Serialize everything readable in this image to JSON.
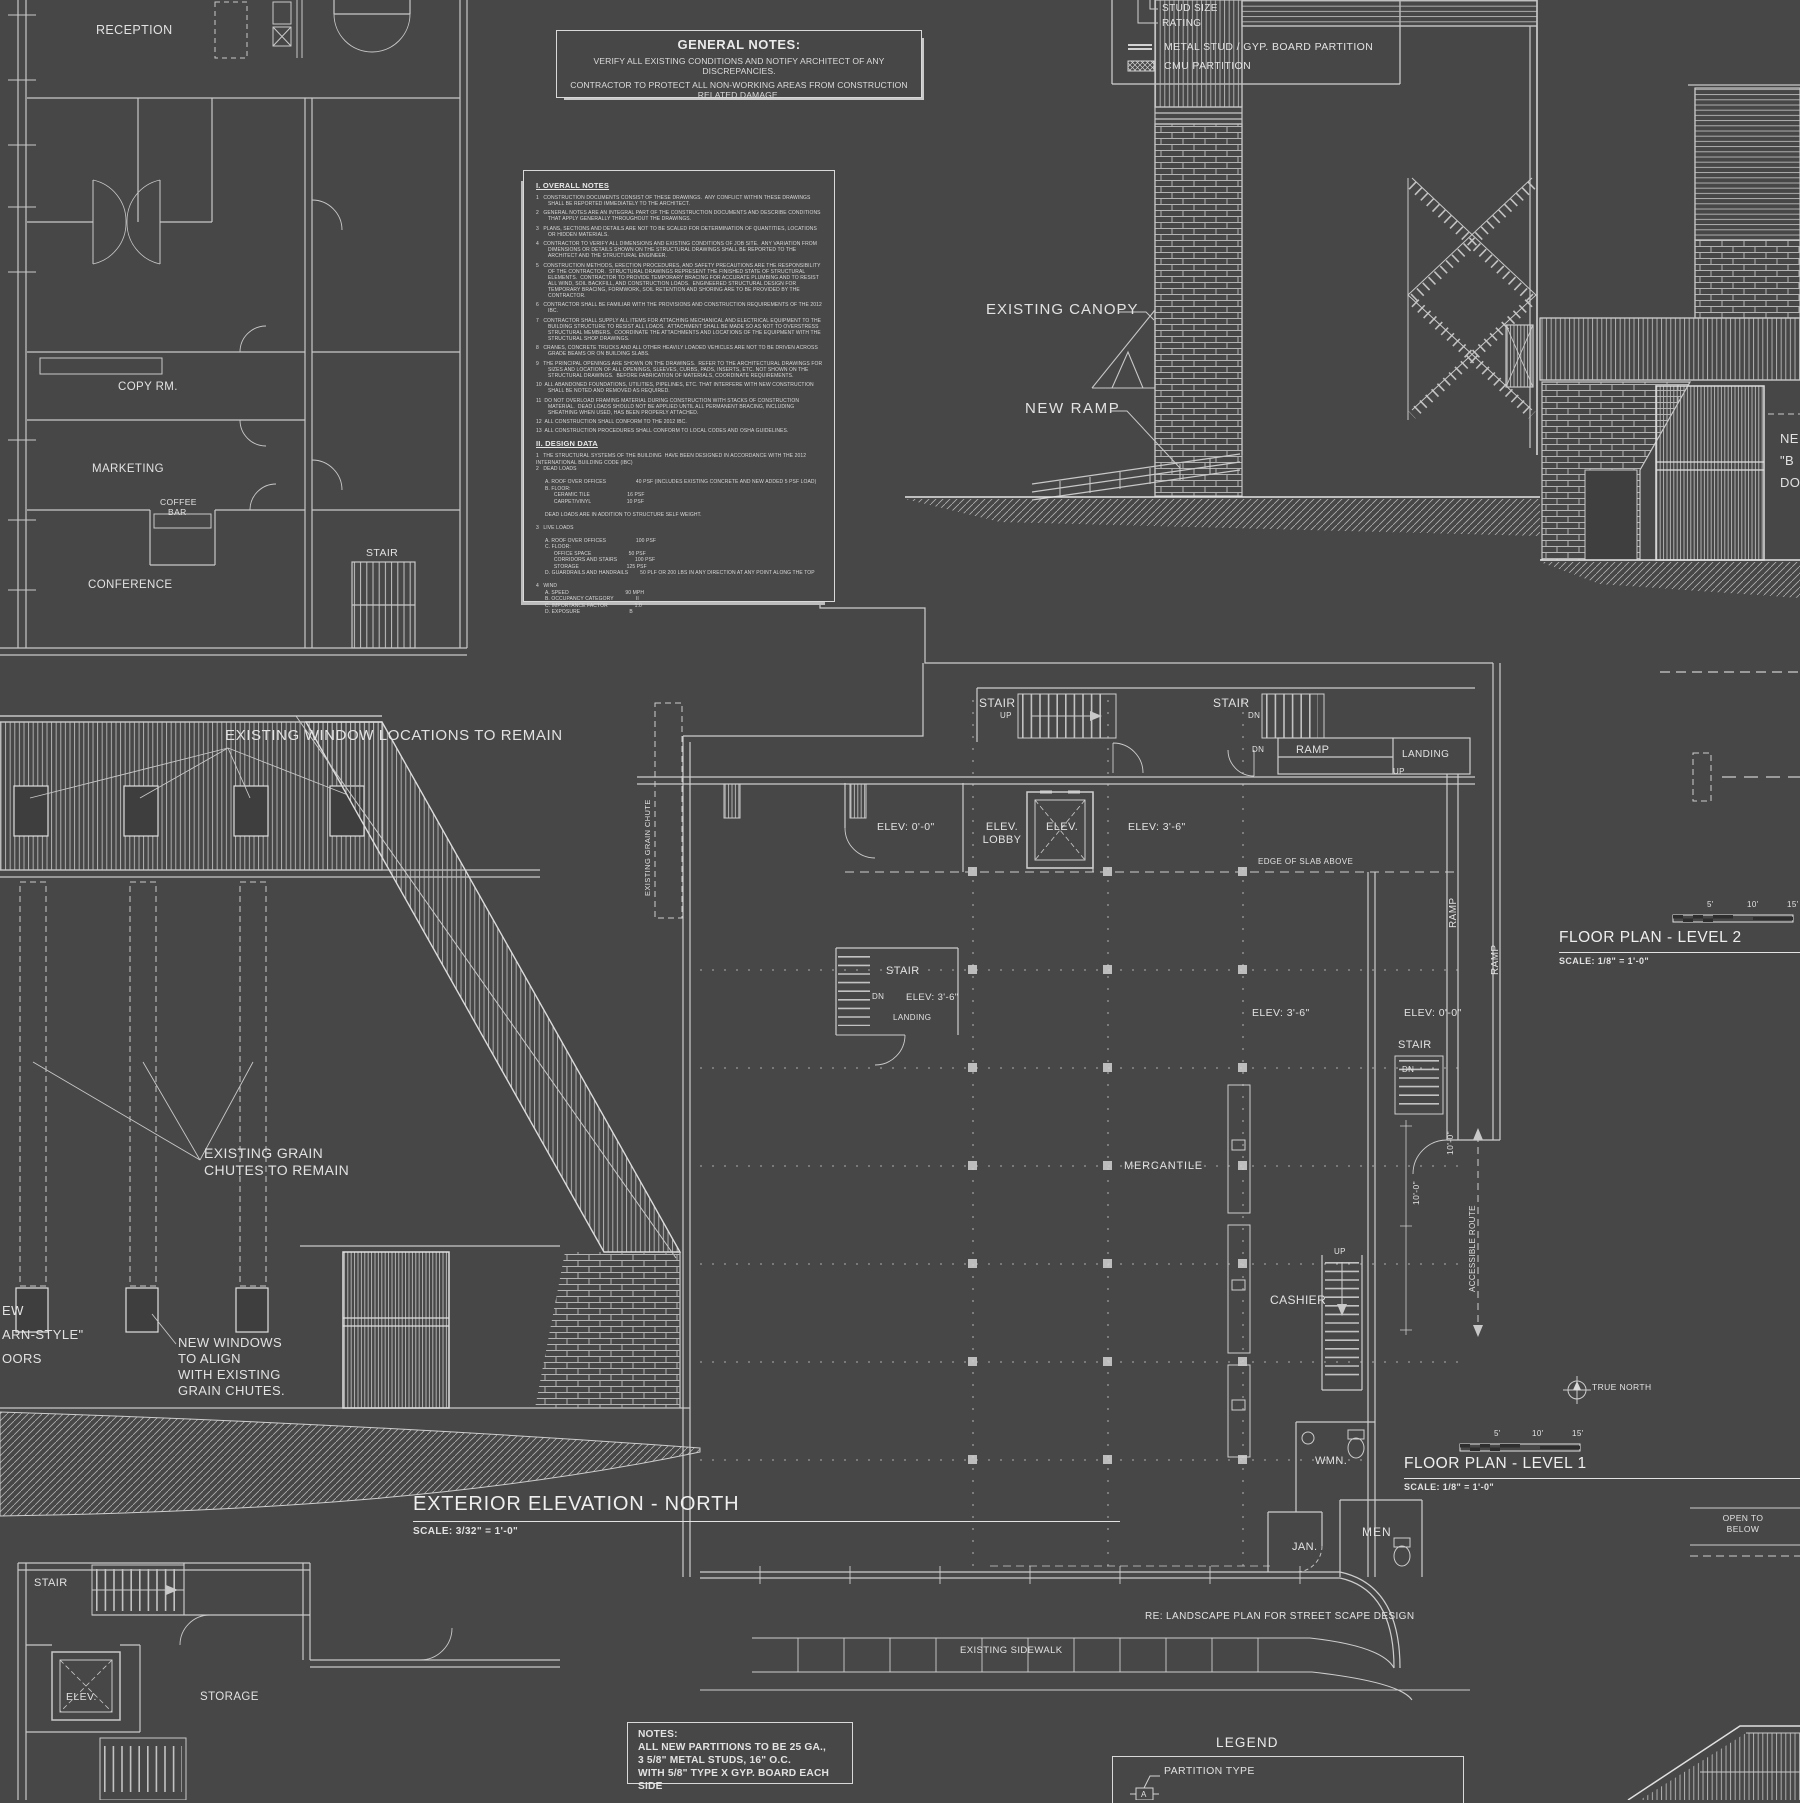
{
  "palette": {
    "background": "#474747",
    "line": "#c8c8c8",
    "bright_line": "#e8e8e8",
    "text": "#e2e2e2"
  },
  "glossary": {
    "stair": "STAIR",
    "up": "UP",
    "dn": "DN",
    "ramp": "RAMP",
    "landing": "LANDING",
    "elev_0": "ELEV: 0'-0\"",
    "elev_36": "ELEV: 3'-6\"",
    "elev": "ELEV."
  },
  "office_plan": {
    "reception": "RECEPTION",
    "copy_room": "COPY RM.",
    "marketing": "MARKETING",
    "coffee_line1": "COFFEE",
    "coffee_line2": "BAR",
    "conference": "CONFERENCE",
    "stair": "STAIR"
  },
  "general_notes": {
    "title": "GENERAL NOTES:",
    "line1": "VERIFY ALL EXISTING CONDITIONS  AND NOTIFY ARCHITECT OF ANY DISCREPANCIES.",
    "line2": "CONTRACTOR TO PROTECT ALL NON-WORKING AREAS FROM CONSTRUCTION",
    "line3": "RELATED DAMAGE."
  },
  "partition_legend": {
    "stud_size": "STUD SIZE",
    "rating": "RATING",
    "metal_stud": "METAL STUD / GYP. BOARD PARTITION",
    "cmu": "CMU PARTITION"
  },
  "overall_notes": {
    "title": "I. OVERALL NOTES",
    "items": [
      "1   CONSTRUCTION DOCUMENTS CONSIST OF THESE DRAWINGS.  ANY CONFLICT WITHIN THESE DRAWINGS SHALL BE REPORTED IMMEDIATELY TO THE ARCHITECT.",
      "2   GENERAL NOTES ARE AN INTEGRAL PART OF THE CONSTRUCTION DOCUMENTS AND DESCRIBE CONDITIONS THAT APPLY GENERALLY THROUGHOUT THE DRAWINGS.",
      "3   PLANS, SECTIONS AND DETAILS ARE NOT TO BE SCALED FOR DETERMINATION OF QUANTITIES, LOCATIONS OR HIDDEN MATERIALS.",
      "4   CONTRACTOR TO VERIFY ALL DIMENSIONS AND EXISTING CONDITIONS OF JOB SITE.  ANY VARIATION FROM DIMENSIONS OR DETAILS SHOWN ON THE STRUCTURAL DRAWINGS SHALL BE REPORTED TO THE ARCHITECT AND THE STRUCTURAL ENGINEER.",
      "5   CONSTRUCTION METHODS, ERECTION PROCEDURES, AND SAFETY PRECAUTIONS ARE THE RESPONSIBILITY OF THE CONTRACTOR.  STRUCTURAL DRAWINGS REPRESENT THE FINISHED STATE OF STRUCTURAL ELEMENTS.  CONTRACTOR TO PROVIDE TEMPORARY BRACING FOR ACCURATE PLUMBING AND TO RESIST ALL WIND, SOIL BACKFILL, AND CONSTRUCTION LOADS.  ENGINEERED STRUCTURAL DESIGN FOR TEMPORARY BRACING, FORMWORK, SOIL RETENTION AND SHORING ARE TO BE PROVIDED BY THE CONTRACTOR.",
      "6   CONTRACTOR SHALL BE FAMILIAR WITH THE PROVISIONS AND CONSTRUCTION REQUIREMENTS OF THE 2012 IBC.",
      "7   CONTRACTOR SHALL SUPPLY ALL ITEMS FOR ATTACHING MECHANICAL AND ELECTRICAL EQUIPMENT TO THE BUILDING STRUCTURE TO RESIST ALL LOADS.  ATTACHMENT SHALL BE MADE SO AS NOT TO OVERSTRESS STRUCTURAL MEMBERS.  COORDINATE THE ATTACHMENTS AND LOCATIONS OF THE EQUIPMENT WITH THE STRUCTURAL SHOP DRAWINGS.",
      "8   CRANES, CONCRETE TRUCKS AND ALL OTHER HEAVILY LOADED VEHICLES ARE NOT TO BE DRIVEN ACROSS GRADE BEAMS OR ON BUILDING SLABS.",
      "9   THE PRINCIPAL OPENINGS ARE SHOWN ON THE DRAWINGS.  REFER TO THE ARCHITECTURAL DRAWINGS FOR SIZES AND LOCATION OF ALL OPENINGS, SLEEVES, CURBS, PADS, INSERTS, ETC. NOT SHOWN ON THE STRUCTURAL DRAWINGS.  BEFORE FABRICATION OF MATERIALS, COORDINATE REQUIREMENTS.",
      "10  ALL ABANDONED FOUNDATIONS, UTILITIES, PIPELINES, ETC. THAT INTERFERE WITH NEW CONSTRUCTION SHALL BE NOTED AND REMOVED AS REQUIRED.",
      "11  DO NOT OVERLOAD FRAMING MATERIAL DURING CONSTRUCTION WITH STACKS OF CONSTRUCTION MATERIAL.  DEAD LOADS SHOULD NOT BE APPLIED UNTIL ALL PERMANENT BRACING, INCLUDING SHEATHING WHEN USED, HAS BEEN PROPERLY ATTACHED.",
      "12  ALL CONSTRUCTION SHALL CONFORM TO THE 2012 IBC.",
      "13  ALL CONSTRUCTION PROCEDURES SHALL CONFORM TO LOCAL CODES AND OSHA GUIDELINES."
    ],
    "design_title": "II. DESIGN DATA",
    "design_body": "1   THE STRUCTURAL SYSTEMS OF THE BUILDING  HAVE BEEN DESIGNED IN ACCORDANCE WITH THE 2012 INTERNATIONAL BUILDING CODE (IBC)\n2   DEAD LOADS\n\n      A. ROOF OVER OFFICES                    40 PSF (INCLUDES EXISTING CONCRETE AND NEW ADDED 5 PSF LOAD)\n      B. FLOOR:\n            CERAMIC TILE                         16 PSF\n            CARPET/VINYL                        10 PSF\n\n      DEAD LOADS ARE IN ADDITION TO STRUCTURE SELF WEIGHT.\n\n3   LIVE LOADS\n\n      A. ROOF OVER OFFICES                    100 PSF\n      C. FLOOR:\n            OFFICE SPACE                         50 PSF\n            CORRIDORS AND STAIRS            100 PSF\n            STORAGE                                125 PSF\n      D. GUARDRAILS AND HANDRAILS        50 PLF OR 200 LBS IN ANY DIRECTION AT ANY POINT ALONG THE TOP\n\n4   WIND\n      A. SPEED                                      90 MPH\n      B. OCCUPANCY CATEGORY               II\n      C. IMPORTANCE FACTOR                  1.0\n      D. EXPOSURE                                 B"
  },
  "section": {
    "existing_canopy": "EXISTING CANOPY",
    "new_ramp": "NEW RAMP",
    "clip1": "NE",
    "clip2": "\"B",
    "clip3": "DO"
  },
  "elevation": {
    "window_note": "EXISTING WINDOW LOCATIONS TO REMAIN",
    "chute_note1": "EXISTING GRAIN",
    "chute_note2": "CHUTES TO REMAIN",
    "nw1": "NEW WINDOWS",
    "nw2": "TO ALIGN",
    "nw3": "WITH EXISTING",
    "nw4": "GRAIN CHUTES.",
    "clip1": "EW",
    "clip2": "ARN-STYLE\"",
    "clip3": "OORS",
    "title": "EXTERIOR ELEVATION - NORTH",
    "scale": "SCALE: 3/32\" = 1'-0\""
  },
  "level1": {
    "elev_lobby1": "ELEV.",
    "elev_lobby2": "LOBBY",
    "edge_of_slab": "EDGE OF SLAB ABOVE",
    "grain_chute": "EXISTING GRAIN CHUTE",
    "mercantile": "MERCANTILE",
    "cashier": "CASHIER",
    "accessible_route": "ACCESSIBLE ROUTE",
    "dim_10": "10'-0\"",
    "wmn": "WMN.",
    "men": "MEN",
    "jan": "JAN.",
    "landscape_note": "RE: LANDSCAPE PLAN FOR STREET SCAPE DESIGN",
    "sidewalk": "EXISTING SIDEWALK",
    "true_north": "TRUE NORTH",
    "open1": "OPEN TO",
    "open2": "BELOW",
    "title": "FLOOR PLAN - LEVEL 1",
    "scale": "SCALE: 1/8\" = 1'-0\"",
    "bar5": "5'",
    "bar10": "10'",
    "bar15": "15'"
  },
  "level2": {
    "title": "FLOOR PLAN - LEVEL 2",
    "scale": "SCALE: 1/8\" = 1'-0\"",
    "bar5": "5'",
    "bar10": "10'",
    "bar15": "15'"
  },
  "basement": {
    "stair": "STAIR",
    "elev": "ELEV.",
    "storage": "STORAGE"
  },
  "notes_box": {
    "title": "NOTES:",
    "line1": "ALL NEW PARTITIONS TO BE 25 GA.,",
    "line2": "3 5/8\" METAL STUDS, 16\" O.C.",
    "line3": "WITH 5/8\" TYPE X GYP. BOARD EACH SIDE"
  },
  "legend_box": {
    "title": "LEGEND",
    "partition_type": "PARTITION TYPE",
    "symbol": "A"
  }
}
